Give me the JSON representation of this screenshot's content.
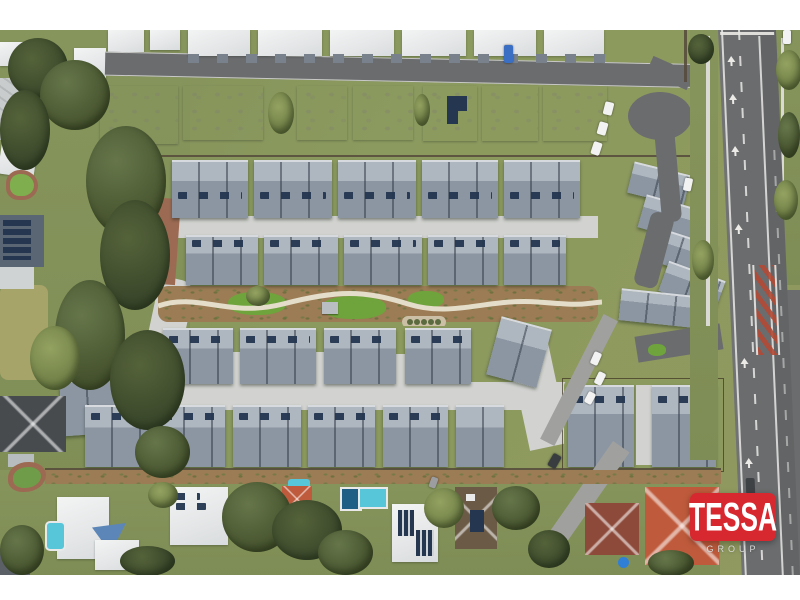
{
  "meta": {
    "type": "aerial-drone-photograph",
    "description": "Top-down aerial photo of a modern townhouse estate: rows of blue-grey metal roofs with solar panels, white-roofed units to the north, a landscaped central walkway, a cul-de-sac and main arterial road on the east, bushland to the west and suburban homes with swimming pools to the south."
  },
  "watermark": {
    "brand": "TESSA",
    "subtitle": "GROUP"
  },
  "colors": {
    "logo-red": "#d7282f",
    "logo-text": "#ffffff",
    "logo-sub": "#d9d9d9",
    "roof-light": "#aeb6bf",
    "roof-mid": "#8c96a2",
    "roof-ridge": "#d7dbe0",
    "white-roof": "#ebedee",
    "solar": "#243650",
    "asphalt": "#6a6c6e",
    "concrete": "#d2d3d0",
    "path": "#e3dcc9",
    "grass": "#8b9a5e",
    "lawn": "#6fa33c",
    "tree-dark": "#46532e",
    "tree-mid": "#66764a",
    "mulch": "#9b7c54",
    "pool": "#56c6d8",
    "pool-dark": "#1f5f86",
    "terracotta": "#bf5b3c",
    "maroon": "#8d4a3a",
    "brick": "#9c6a52",
    "chevron-red": "#b34a35",
    "dark-roof": "#474b4e",
    "blue-sail": "#5d86b8"
  },
  "regions": [
    "bushland-west",
    "white-unit-row-north",
    "white-roof-row",
    "grey-townhouse-row-1",
    "grey-townhouse-row-2",
    "central-garden-walkway",
    "grey-townhouse-row-3",
    "grey-townhouse-row-4",
    "cul-de-sac",
    "main-road-east",
    "east-townhouse-cluster",
    "suburban-houses-south",
    "swimming-pools",
    "tessa-group-watermark"
  ]
}
